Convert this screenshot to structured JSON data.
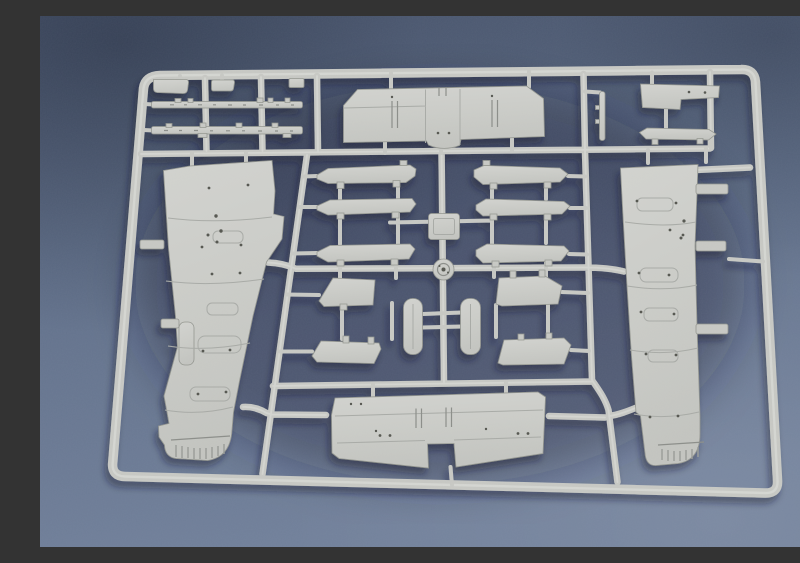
{
  "scene": {
    "description": "Photograph of a light grey injection-moulded plastic sprue (model kit parts tree) with aircraft wing parts, lying on a blue-grey textured surface",
    "object": "model-kit-sprue",
    "surface": "blue-grey matte board",
    "plastic_color_name": "light grey"
  },
  "colors": {
    "bg_top": "#4f5c75",
    "bg_mid": "#61708a",
    "bg_bottom": "#71809a",
    "inner_shadow": "rgba(25,33,54,0.35)",
    "plastic": "#c8c9c4",
    "plastic_light": "#dcddd8",
    "plastic_dark": "#a9aba6",
    "plastic_edge": "#94968f",
    "detail": "#54564f",
    "shadow": "#151c2d"
  },
  "sprue": {
    "frame": "rectangular runner frame with rounded corners",
    "parts": [
      {
        "id": "left-wing-panel",
        "label": "large wing half (left)",
        "count": 1
      },
      {
        "id": "right-wing-panel",
        "label": "large wing half (right)",
        "count": 1
      },
      {
        "id": "upper-wing-center",
        "label": "upper wing centre section",
        "count": 1
      },
      {
        "id": "lower-wing-center",
        "label": "lower wing centre section",
        "count": 1
      },
      {
        "id": "leading-edge-strip",
        "label": "long thin leading-edge strip",
        "count": 2
      },
      {
        "id": "wing-slat",
        "label": "slat / aileron",
        "count": 6
      },
      {
        "id": "wing-flap",
        "label": "flap",
        "count": 4
      },
      {
        "id": "strut-capsule",
        "label": "rounded strut",
        "count": 2
      },
      {
        "id": "hub-disc",
        "label": "round disc part",
        "count": 1
      },
      {
        "id": "gate-pad",
        "label": "square gate pad",
        "count": 1
      },
      {
        "id": "step-panel",
        "label": "stepped panel",
        "count": 1
      },
      {
        "id": "small-slat",
        "label": "small slat",
        "count": 1
      },
      {
        "id": "pitot-stick",
        "label": "thin stick part",
        "count": 1
      },
      {
        "id": "small-bracket",
        "label": "small bracket",
        "count": 3
      }
    ]
  }
}
